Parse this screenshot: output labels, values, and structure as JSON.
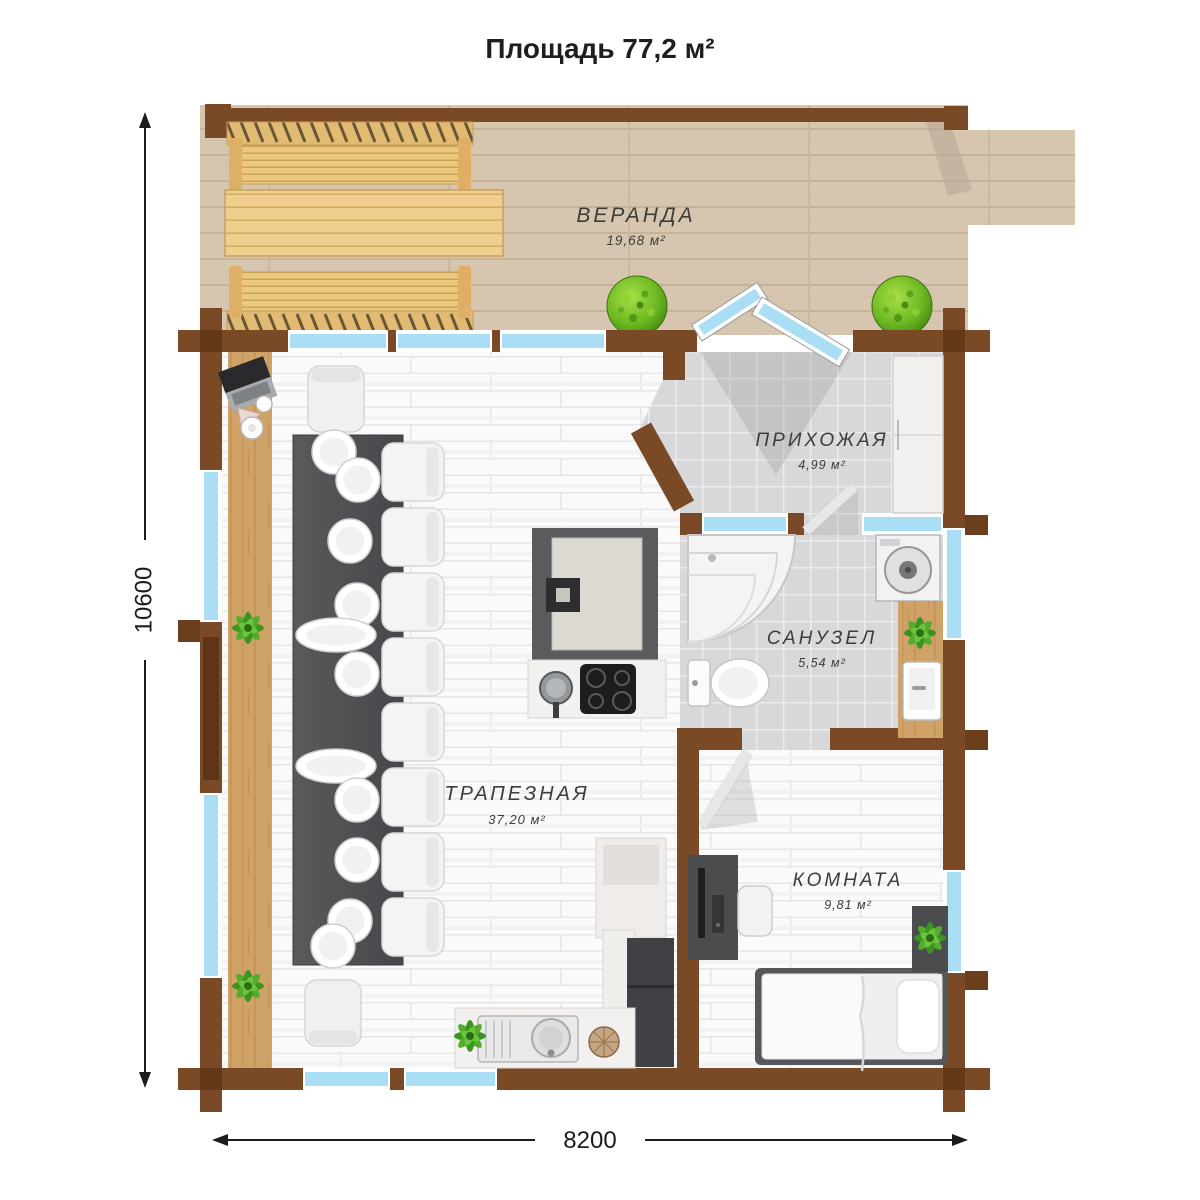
{
  "title": "Площадь 77,2 м²",
  "rooms": {
    "veranda": {
      "name": "ВЕРАНДА",
      "area": "19,68 м²"
    },
    "hallway": {
      "name": "ПРИХОЖАЯ",
      "area": "4,99 м²"
    },
    "bathroom": {
      "name": "САНУЗЕЛ",
      "area": "5,54 м²"
    },
    "dining": {
      "name": "ТРАПЕЗНАЯ",
      "area": "37,20 м²"
    },
    "bedroom": {
      "name": "КОМНАТА",
      "area": "9,81 м²"
    }
  },
  "dimensions": {
    "height_mm": "10600",
    "width_mm": "8200"
  },
  "colors": {
    "wall": "#7a4a26",
    "wall_notch": "#5e3517",
    "window_glass": "#aadef5",
    "deck_wood": "#d7c6af",
    "bench_wood": "#eac87e",
    "floor_plank": "#fbfbfc",
    "floor_tile": "#d9d9db",
    "table_dark": "#4e4f51"
  }
}
